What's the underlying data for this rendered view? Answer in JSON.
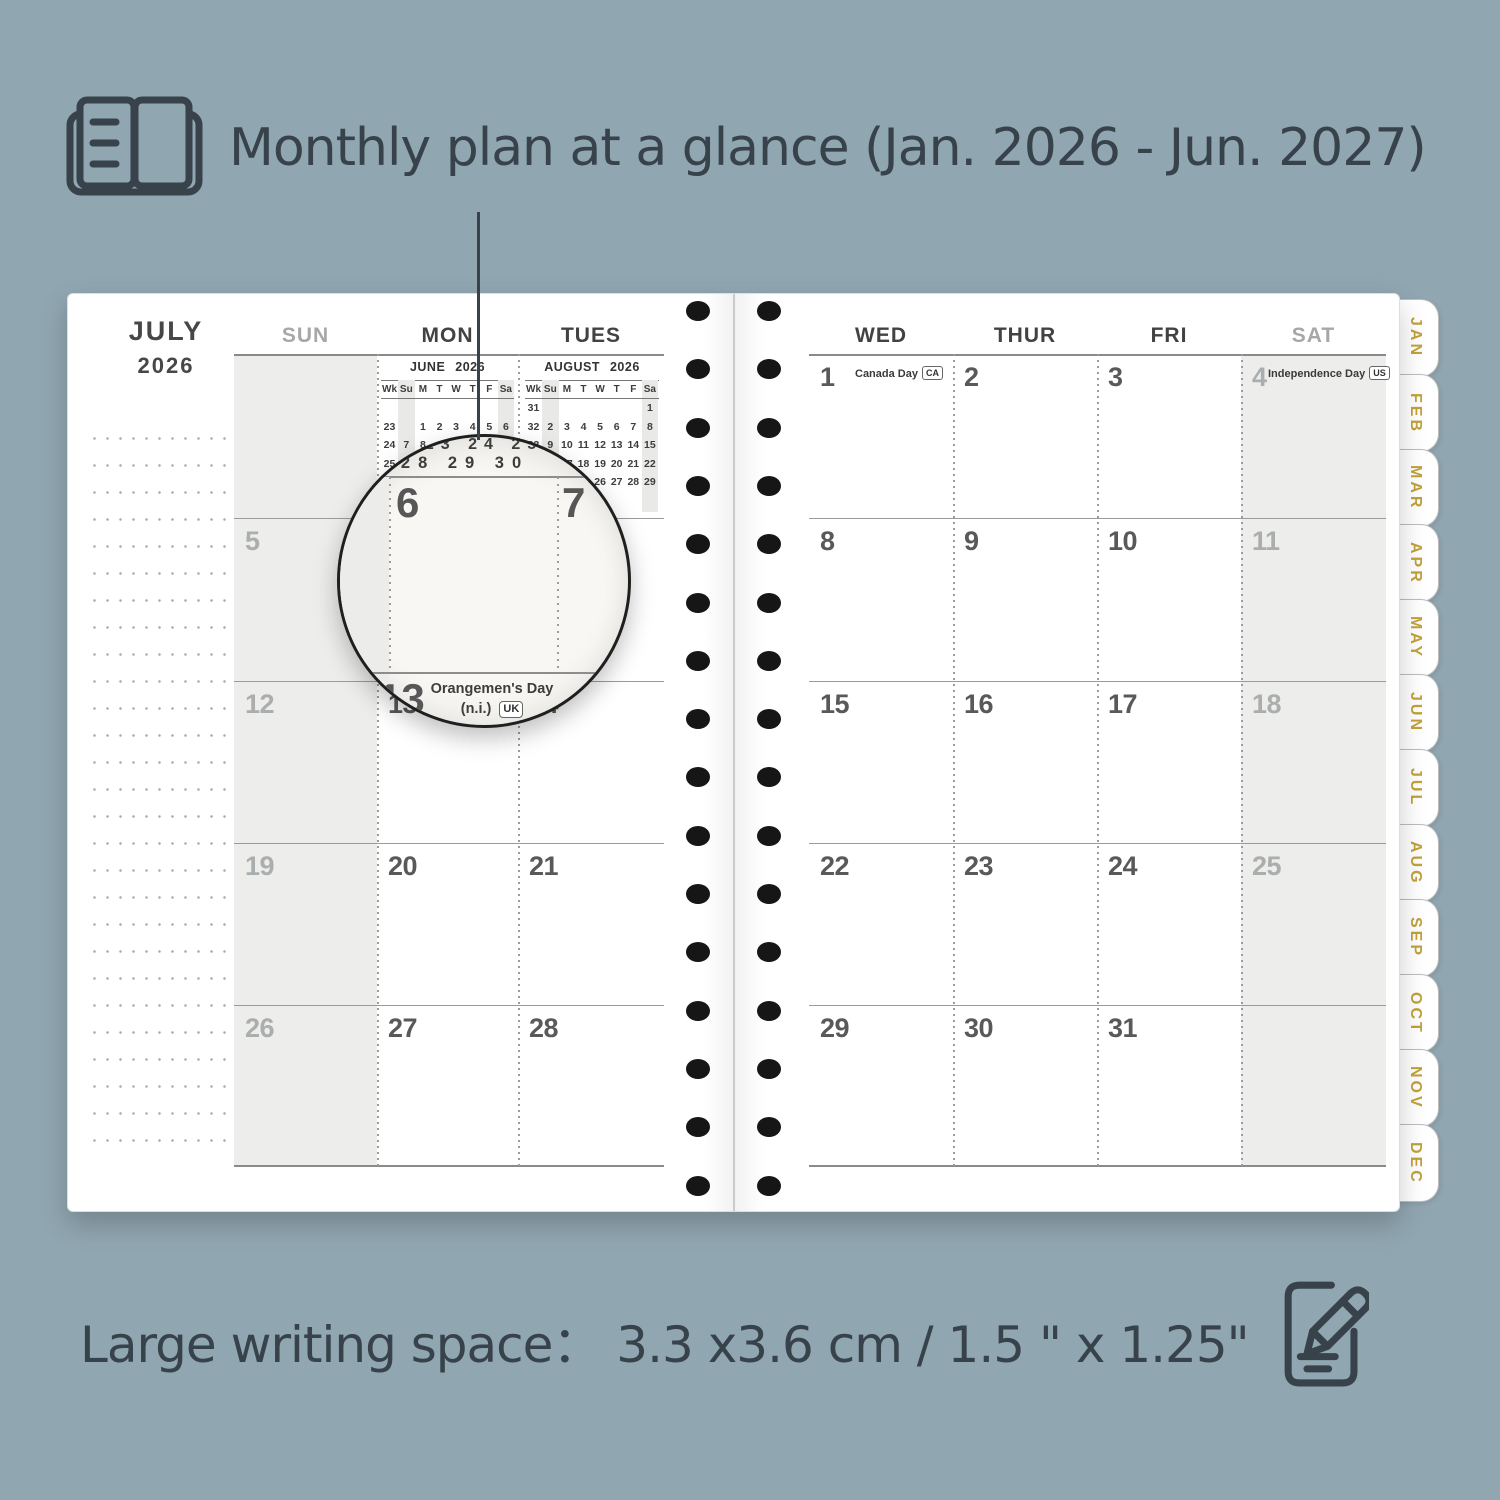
{
  "colors": {
    "background": "#90a6b1",
    "ink": "#37424b",
    "tab_gold": "#c2a23a",
    "page": "#ffffff",
    "shaded_column": "#ededeb"
  },
  "icons": {
    "header": "open-planner-book-icon",
    "footer": "pencil-writing-icon"
  },
  "header": {
    "title": "Monthly plan at a glance (Jan. 2026 - Jun. 2027)"
  },
  "footer": {
    "caption": "Large writing space：  3.3 x3.6  cm / 1.5 \" x 1.25\""
  },
  "planner": {
    "month": "JULY",
    "year": "2026",
    "left_day_headers": [
      "SUN",
      "MON",
      "TUES"
    ],
    "right_day_headers": [
      "WED",
      "THUR",
      "FRI",
      "SAT"
    ],
    "left_weeks": [
      [
        "",
        "",
        ""
      ],
      [
        "5",
        "6",
        "7"
      ],
      [
        "12",
        "13",
        "14"
      ],
      [
        "19",
        "20",
        "21"
      ],
      [
        "26",
        "27",
        "28"
      ]
    ],
    "right_weeks": [
      [
        {
          "d": "1",
          "holiday": "Canada Day",
          "tag": "CA"
        },
        {
          "d": "2"
        },
        {
          "d": "3"
        },
        {
          "d": "4",
          "holiday": "Independence Day",
          "tag": "US"
        }
      ],
      [
        {
          "d": "8"
        },
        {
          "d": "9"
        },
        {
          "d": "10"
        },
        {
          "d": "11"
        }
      ],
      [
        {
          "d": "15"
        },
        {
          "d": "16"
        },
        {
          "d": "17"
        },
        {
          "d": "18"
        }
      ],
      [
        {
          "d": "22"
        },
        {
          "d": "23"
        },
        {
          "d": "24"
        },
        {
          "d": "25"
        }
      ],
      [
        {
          "d": "29"
        },
        {
          "d": "30"
        },
        {
          "d": "31"
        },
        {
          "d": ""
        }
      ]
    ],
    "mini_calendars": [
      {
        "title": "JUNE 2026",
        "dow": [
          "Wk",
          "Su",
          "M",
          "T",
          "W",
          "T",
          "F",
          "Sa"
        ],
        "rows": [
          [
            "23",
            "",
            "1",
            "2",
            "3",
            "4",
            "5",
            "6"
          ],
          [
            "24",
            "7",
            "8",
            "9",
            "10",
            "11",
            "12",
            "13"
          ],
          [
            "25",
            "14",
            "15",
            "16",
            "17",
            "18",
            "19",
            "20"
          ],
          [
            "26",
            "21",
            "22",
            "23",
            "24",
            "25",
            "26",
            "27"
          ],
          [
            "27",
            "28",
            "29",
            "30",
            "",
            "",
            "",
            ""
          ]
        ]
      },
      {
        "title": "AUGUST 2026",
        "dow": [
          "Wk",
          "Su",
          "M",
          "T",
          "W",
          "T",
          "F",
          "Sa"
        ],
        "rows": [
          [
            "31",
            "",
            "",
            "",
            "",
            "",
            "",
            "1"
          ],
          [
            "32",
            "2",
            "3",
            "4",
            "5",
            "6",
            "7",
            "8"
          ],
          [
            "33",
            "9",
            "10",
            "11",
            "12",
            "13",
            "14",
            "15"
          ],
          [
            "34",
            "16",
            "17",
            "18",
            "19",
            "20",
            "21",
            "22"
          ],
          [
            "35",
            "23",
            "24",
            "25",
            "26",
            "27",
            "28",
            "29"
          ],
          [
            "36",
            "30",
            "31",
            "",
            "",
            "",
            "",
            ""
          ]
        ]
      }
    ],
    "tabs": [
      "JAN",
      "FEB",
      "MAR",
      "APR",
      "MAY",
      "JUN",
      "JUL",
      "AUG",
      "SEP",
      "OCT",
      "NOV",
      "DEC"
    ]
  },
  "lens": {
    "mini_top": "22 23 24 25 26",
    "mini_bottom": "27 28 29 30",
    "day_left": "6",
    "day_right": "7",
    "day_bottom": "13",
    "holiday": "Orangemen's Day",
    "holiday_suffix": "(n.i.)",
    "holiday_tag": "UK"
  }
}
